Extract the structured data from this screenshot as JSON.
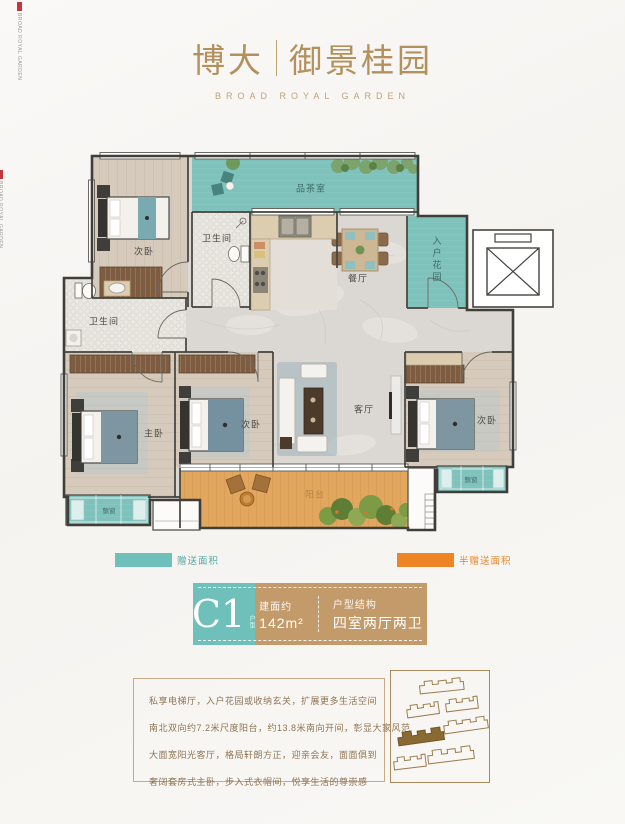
{
  "brand": {
    "title_left": "博大",
    "title_right": "御景桂园",
    "subtitle": "BROAD ROYAL GARDEN",
    "corner_text": "BROAD ROYAL GARDEN"
  },
  "colors": {
    "gold": "#b3915c",
    "teal": "#6fc0ba",
    "orange": "#ee8424",
    "tan": "#c39a6a"
  },
  "floor_plan": {
    "labels": {
      "bedroom_top": "次卧",
      "bathroom_top": "卫生间",
      "tea_room": "品茶室",
      "dining": "餐厅",
      "entry_garden": "入户花园",
      "bathroom_left": "卫生间",
      "master": "主卧",
      "bedroom_mid": "次卧",
      "living": "客厅",
      "bedroom_right": "次卧",
      "balcony": "阳台",
      "bay_left": "飘窗",
      "bay_right": "飘窗"
    }
  },
  "legend": {
    "gift_label": "赠送面积",
    "half_gift_label": "半赠送面积"
  },
  "unit": {
    "code": "C1",
    "code_suffix": "户型",
    "area_label": "建面约",
    "area_value": "142m²",
    "structure_label": "户型结构",
    "structure_value": "四室两厅两卫"
  },
  "description": {
    "lines": [
      "私享电梯厅，入户花园或收纳玄关，扩展更多生活空间",
      "南北双向约7.2米尺度阳台，约13.8米南向开间，彰显大家风范",
      "大面宽阳光客厅，格局轩朗方正，迎亲会友，面面俱到",
      "奢阔套房式主卧，步入式衣帽间，悦享生活的尊崇感"
    ]
  }
}
